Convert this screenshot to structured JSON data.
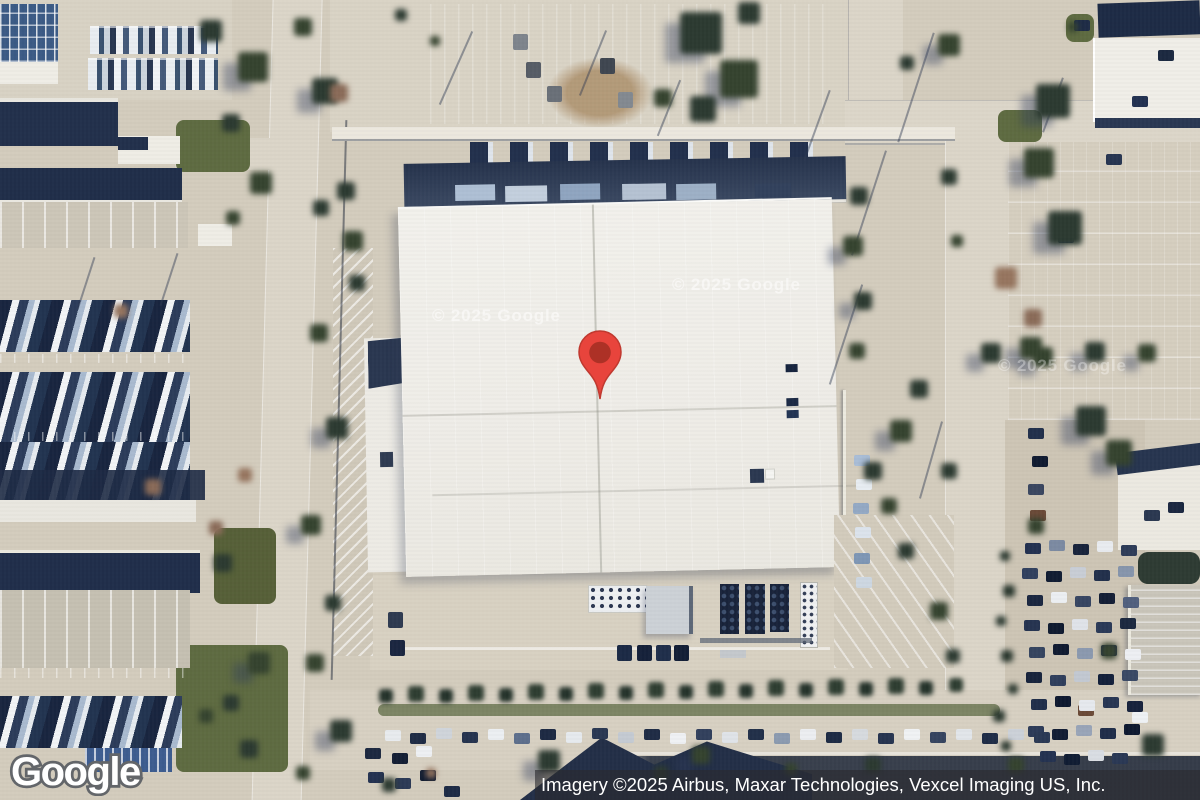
{
  "map": {
    "logo_text": "Google",
    "attribution_text": "Imagery ©2025 Airbus, Maxar Technologies, Vexcel Imaging US, Inc.",
    "watermarks": [
      "© 2025 Google",
      "© 2025 Google",
      "© 2025 Google"
    ],
    "marker": {
      "fill": "#E8443C",
      "dot": "#AD3126"
    },
    "colors": {
      "pavement": "#d3ccbd",
      "road": "#dbd5c8",
      "roof_white": "#f1f0eb",
      "roof_navy": "#22304b",
      "dock_navy": "#2c3950",
      "tree_green": "#2c3a31",
      "tree_brown": "#8a6b58",
      "grass": "#5e6b41",
      "attribution_bg": "rgba(42,42,46,0.62)",
      "logo_outline": "#63666a"
    }
  }
}
